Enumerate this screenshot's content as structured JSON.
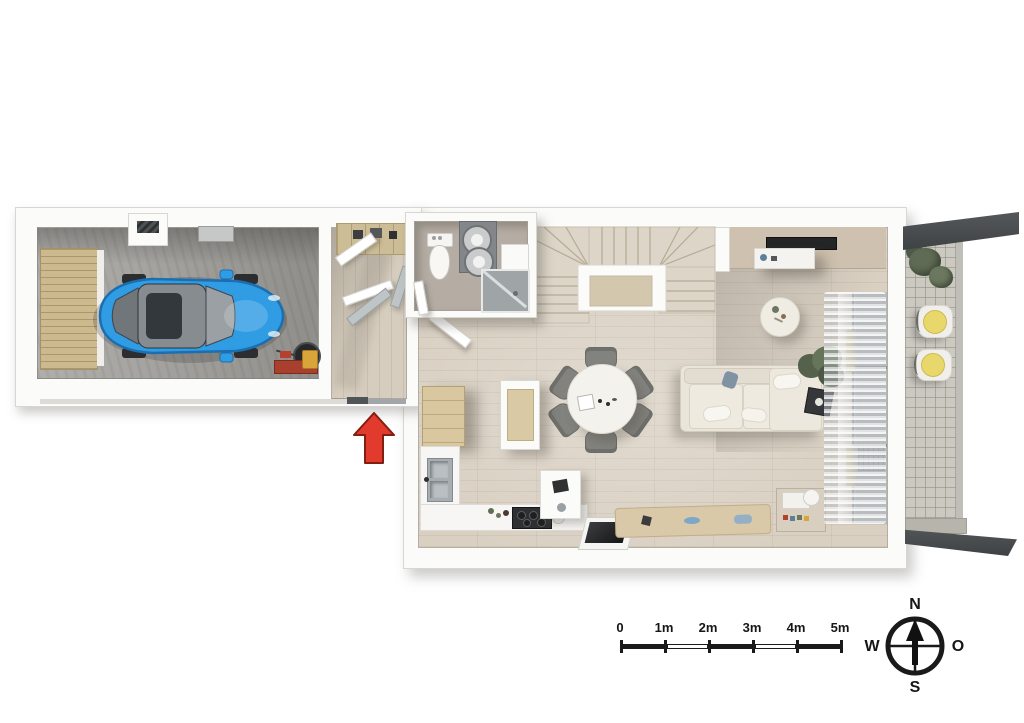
{
  "scale_bar": {
    "labels": [
      "0",
      "1m",
      "2m",
      "3m",
      "4m",
      "5m"
    ]
  },
  "compass": {
    "north_label": "N",
    "east_label": "O",
    "south_label": "S",
    "west_label": "W"
  },
  "colors": {
    "background": "#ffffff",
    "wall_white": "#fbfbfa",
    "wood_floor": "#d9d0c2",
    "garage_concrete": "#a6a5a1",
    "bathroom_floor": "#b5ada3",
    "car_blue": "#2f9ce4",
    "entrance_arrow_red": "#e23a2d",
    "terrace_paver": "#ccc9c1",
    "awning_dark_gray": "#4b4e50",
    "chair_cushion_yellow": "#e8d76b",
    "plant_green": "#5f6b55",
    "sofa_cream": "#e9e5da",
    "dining_chair_gray": "#82827e",
    "kitchen_wood": "#d8c79f",
    "scale_compass_black": "#1a1a1a"
  }
}
